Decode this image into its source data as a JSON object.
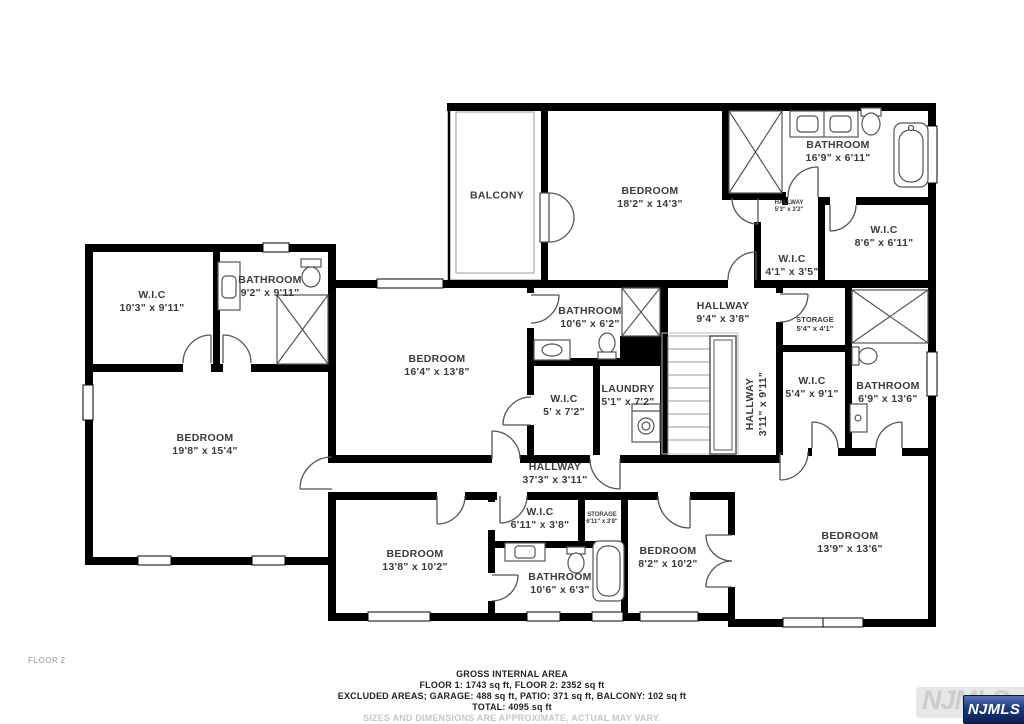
{
  "floor_label": "FLOOR 2",
  "footer": {
    "title": "GROSS INTERNAL AREA",
    "line1": "FLOOR 1: 1743 sq ft, FLOOR 2: 2352 sq ft",
    "line2": "EXCLUDED AREAS; GARAGE: 488 sq ft, PATIO: 371 sq ft, BALCONY: 102 sq ft",
    "line3": "TOTAL: 4095 sq ft",
    "disclaimer": "SIZES AND DIMENSIONS ARE APPROXIMATE, ACTUAL MAY VARY."
  },
  "watermark": {
    "text": "NJMLS",
    "badge": "NJMLS",
    "badge_color": "#1d3a7e"
  },
  "colors": {
    "wall": "#000000",
    "label": "#3b3b3b",
    "muted": "#c6c6c6"
  },
  "rooms": [
    {
      "id": "balcony",
      "name": "BALCONY",
      "dims": ""
    },
    {
      "id": "bedroom-top",
      "name": "BEDROOM",
      "dims": "18'2\" x 14'3\""
    },
    {
      "id": "bathroom-top",
      "name": "BATHROOM",
      "dims": "16'9\" x 6'11\""
    },
    {
      "id": "hallway-small",
      "name": "HALLWAY",
      "dims": "5'3\" x 3'2\""
    },
    {
      "id": "wic-86",
      "name": "W.I.C",
      "dims": "8'6\" x 6'11\""
    },
    {
      "id": "wic-41",
      "name": "W.I.C",
      "dims": "4'1\" x 3'5\""
    },
    {
      "id": "wic-103",
      "name": "W.I.C",
      "dims": "10'3\" x 9'11\""
    },
    {
      "id": "bathroom-92",
      "name": "BATHROOM",
      "dims": "9'2\" x 9'11\""
    },
    {
      "id": "bedroom-198",
      "name": "BEDROOM",
      "dims": "19'8\" x 15'4\""
    },
    {
      "id": "bedroom-164",
      "name": "BEDROOM",
      "dims": "16'4\" x 13'8\""
    },
    {
      "id": "bathroom-106",
      "name": "BATHROOM",
      "dims": "10'6\" x 6'2\""
    },
    {
      "id": "wic-5",
      "name": "W.I.C",
      "dims": "5' x 7'2\""
    },
    {
      "id": "laundry",
      "name": "LAUNDRY",
      "dims": "5'1\" x 7'2\""
    },
    {
      "id": "hallway-94",
      "name": "HALLWAY",
      "dims": "9'4\" x 3'8\""
    },
    {
      "id": "storage-54",
      "name": "STORAGE",
      "dims": "5'4\" x 4'1\""
    },
    {
      "id": "hallway-vertical",
      "name": "HALLWAY",
      "dims": "3'11\" x 9'11\""
    },
    {
      "id": "wic-54",
      "name": "W.I.C",
      "dims": "5'4\" x 9'1\""
    },
    {
      "id": "bathroom-69",
      "name": "BATHROOM",
      "dims": "6'9\" x 13'6\""
    },
    {
      "id": "hallway-373",
      "name": "HALLWAY",
      "dims": "37'3\" x 3'11\""
    },
    {
      "id": "wic-611",
      "name": "W.I.C",
      "dims": "6'11\" x 3'8\""
    },
    {
      "id": "storage-611",
      "name": "STORAGE",
      "dims": "6'11\" x 3'8\""
    },
    {
      "id": "bedroom-138",
      "name": "BEDROOM",
      "dims": "13'8\" x 10'2\""
    },
    {
      "id": "bathroom-bottom",
      "name": "BATHROOM",
      "dims": "10'6\" x 6'3\""
    },
    {
      "id": "bedroom-82",
      "name": "BEDROOM",
      "dims": "8'2\" x 10'2\""
    },
    {
      "id": "bedroom-139",
      "name": "BEDROOM",
      "dims": "13'9\" x 13'6\""
    }
  ]
}
